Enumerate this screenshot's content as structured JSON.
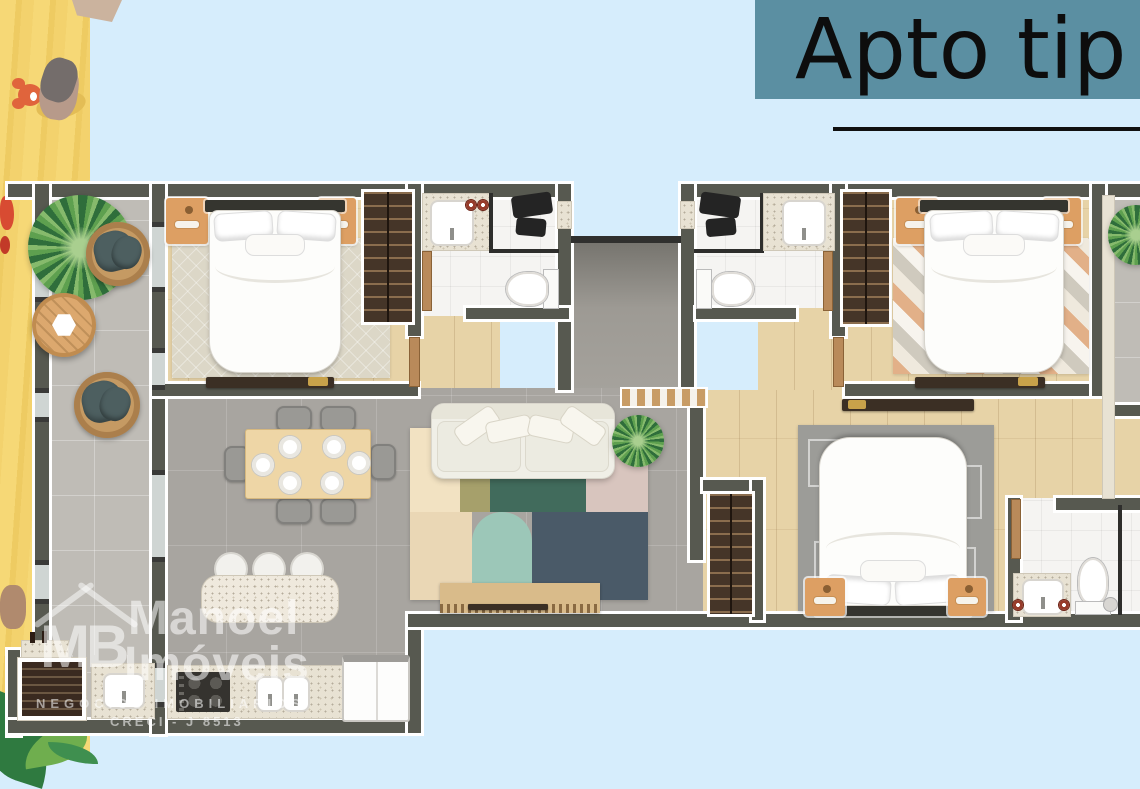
{
  "title": {
    "text": "Apto tip"
  },
  "watermark": {
    "initials": "MB",
    "name_line1": "Manoel",
    "name_line2": "Imóveis",
    "tagline": "NEGÓCIOS IMOBILIÁRIOS",
    "license": "CRECI - J 8513"
  },
  "colors": {
    "background": "#d6edfc",
    "sand": "#f4d672",
    "title_banner": "#5b8fa2",
    "title_text": "#0d0d0d",
    "wall": "#575950",
    "wall_outline": "#ffffff",
    "wood_floor": "#e7d3a7",
    "tile_floor": "#a8a5a0",
    "balcony_floor": "#bfbcb6",
    "bathroom_floor": "#f5f4f2",
    "nightstand_wood": "#dd9f63",
    "wardrobe_dark": "#453528",
    "cushion_teal": "#4d5f60",
    "watermark_text": "rgba(255,255,255,0.55)"
  }
}
